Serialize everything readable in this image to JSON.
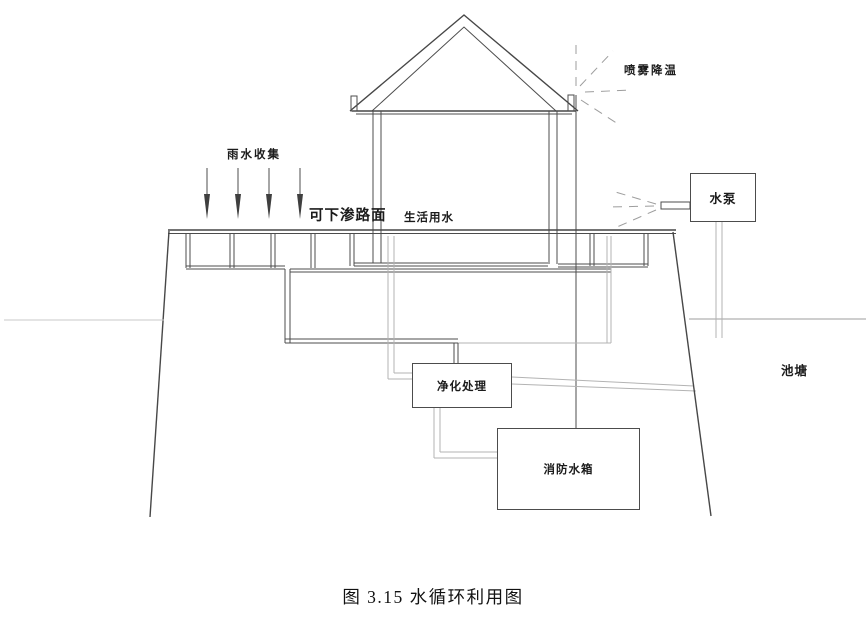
{
  "figure": {
    "caption": "图 3.15 水循环利用图"
  },
  "diagram": {
    "labels": {
      "rain_collection": "雨水收集",
      "permeable_pavement": "可下渗路面",
      "domestic_water": "生活用水",
      "spray_cooling": "喷雾降温",
      "pond": "池塘"
    },
    "boxes": {
      "pump": "水泵",
      "purification": "净化处理",
      "fire_tank": "消防水箱"
    },
    "colors": {
      "line_dark": "#4c4c4c",
      "line_light": "#b3b3b3",
      "spray_dash": "#9d9d9d",
      "background": "#ffffff",
      "text": "#1b1b1b"
    }
  }
}
